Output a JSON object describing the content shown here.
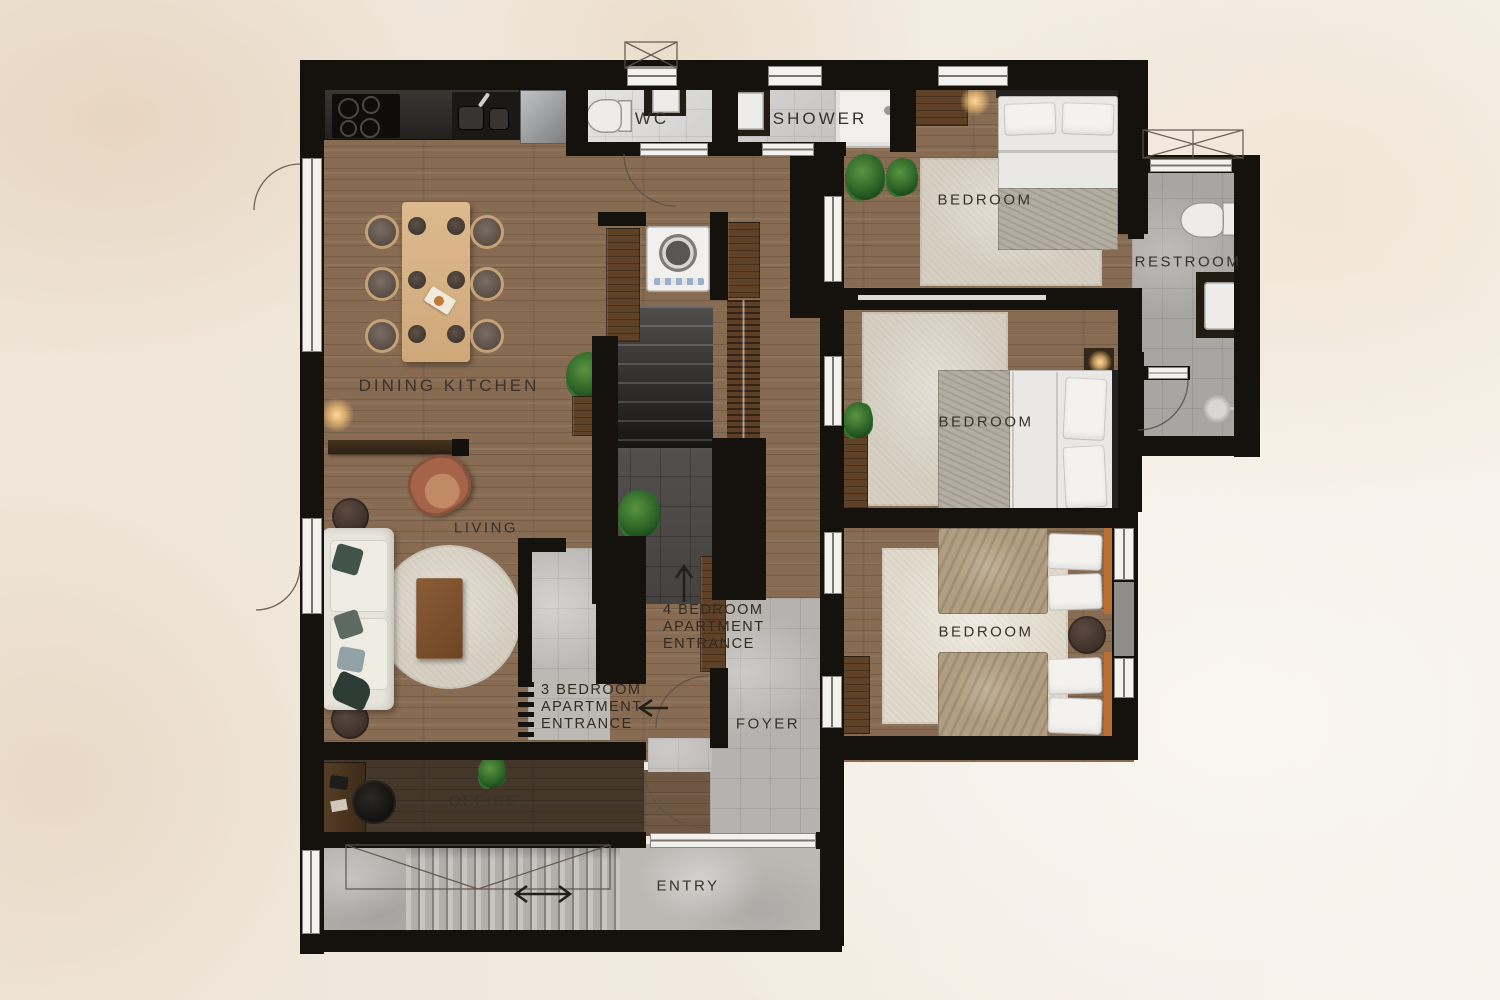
{
  "plan": {
    "title": "apartment-floor-plan",
    "labels": {
      "dining_kitchen": "DINING KITCHEN",
      "wc": "WC",
      "shower": "SHOWER",
      "bedroom1": "BEDROOM",
      "restroom": "RESTROOM",
      "bedroom2": "BEDROOM",
      "bedroom3": "BEDROOM",
      "living": "LIVING",
      "office": "OFFICE",
      "foyer": "FOYER",
      "entry": "ENTRY"
    },
    "annotations": {
      "entrance4_line1": "4 BEDROOM",
      "entrance4_line2": "APARTMENT",
      "entrance4_line3": "ENTRANCE",
      "entrance3_line1": "3 BEDROOM",
      "entrance3_line2": "APARTMENT",
      "entrance3_line3": "ENTRANCE",
      "arrow_up": "up-arrow",
      "arrow_left": "left-arrow",
      "arrow_entry": "double-horizontal-arrow"
    },
    "colors": {
      "wall": "#15110d",
      "wood_floor": "#876b52",
      "tile_light": "#c9c7c5",
      "tile_gray": "#a8a5a2",
      "stair_dark": "#2c2b29",
      "background": "#f1e9de",
      "label_text": "#39322a",
      "rug": "#d7d0c2",
      "cabinet_wood": "#5f4128",
      "bed_linen": "#e9e8e4",
      "blanket_tan": "#b19e80"
    }
  }
}
